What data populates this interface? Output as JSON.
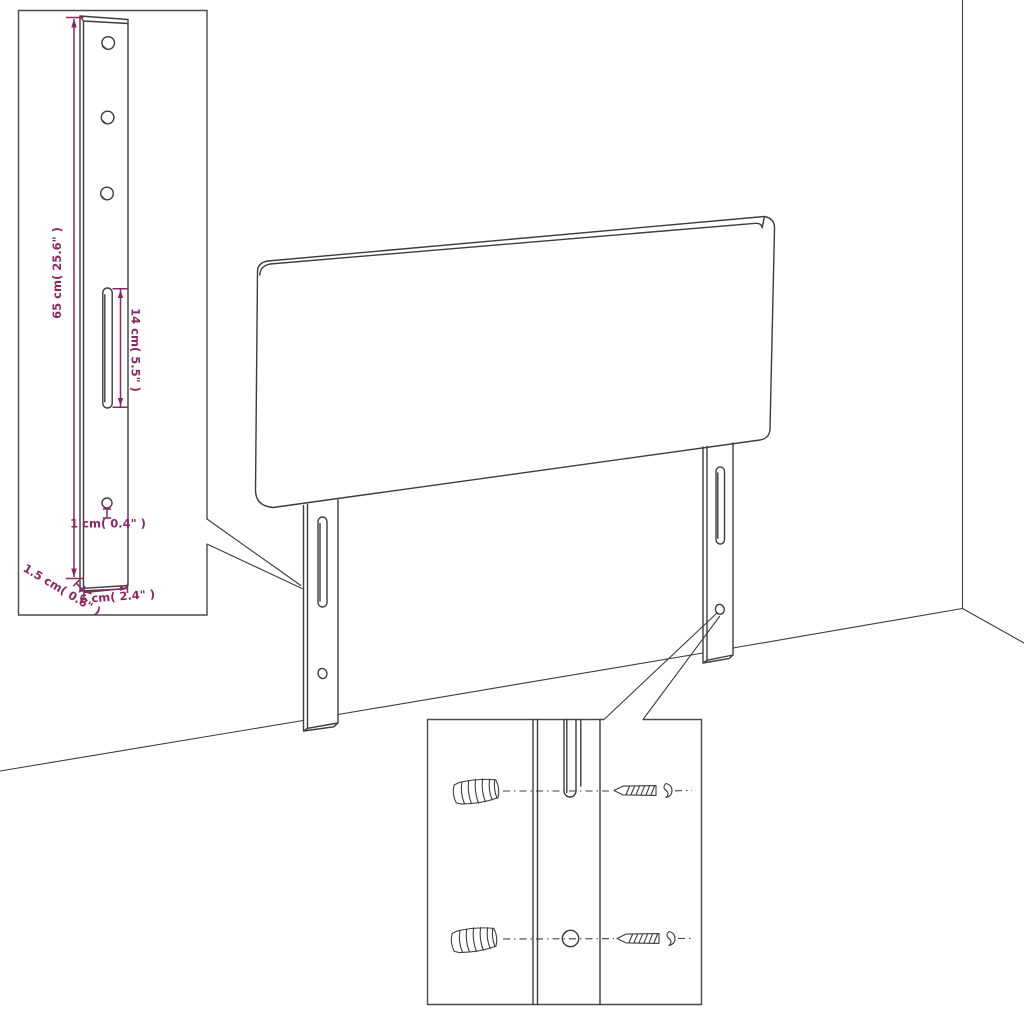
{
  "colors": {
    "outline": "#3d3d3d",
    "accent": "#8e2663",
    "background": "#ffffff",
    "boxline": "#4a4a4a"
  },
  "diagram": {
    "type": "product-dimension-line-drawing",
    "subject": "upholstered headboard with two slotted mounting legs shown against a wall corner",
    "insets": [
      "leg-dimension-detail",
      "wall-mounting-hardware-detail"
    ]
  },
  "leg_detail": {
    "height_label": "65 cm( 25.6\" )",
    "slot_label": "14 cm( 5.5\" )",
    "hole_label": "1 cm( 0.4\" )",
    "thickness_label": "1.5 cm( 0.6\" )",
    "width_label": "6 cm( 2.4\" )"
  }
}
